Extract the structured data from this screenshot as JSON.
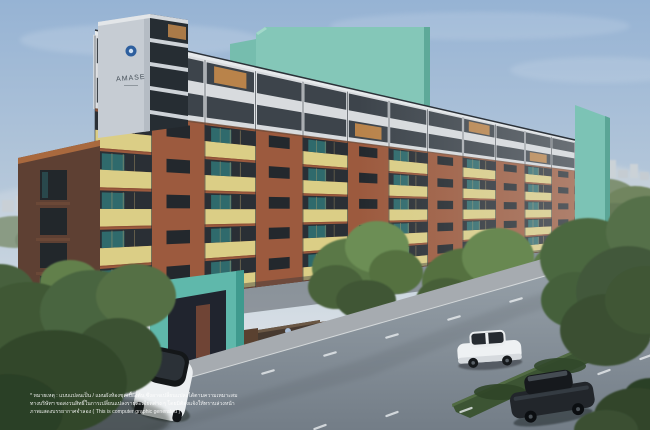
{
  "branding": {
    "tower_sign_label": "AMASE",
    "entrance_sign_label": "AMASE",
    "logo_icon": "amase-logo-icon"
  },
  "disclaimer": {
    "line1": "* หมายเหตุ : แบบแปลนเป็น / แผนผังห้องชุดเบื้องต้น ซึ่งอาจเปลี่ยนแปลงได้ตามความเหมาะสม",
    "line2": "ทางบริษัทฯ ขอสงวนสิทธิ์ในการเปลี่ยนแปลงรายละเอียดต่าง ๆ โดยมิต้องแจ้งให้ทราบล่วงหน้า",
    "line3": "ภาพแสดงบรรยากาศจำลอง ( This is computer graphic generated )"
  },
  "colors": {
    "brand_blue": "#2e5f9e",
    "accent_teal": "#7fc4b6",
    "teal_dark": "#4f9a8c",
    "terracotta": "#9c5a3e",
    "terracotta_dark": "#7e4733",
    "cream_band": "#dbce86",
    "white_panel": "#d8dbde",
    "mullion_dark": "#2f353b",
    "window_dark": "#2a2f35",
    "glass_teal": "#2f6e70",
    "lit_amber": "#b9834a",
    "wood_brown": "#5a4130",
    "sign_wall": "#473a30",
    "fence_corten": "#8a5538",
    "road_grey": "#8d97a0",
    "sidewalk_grey": "#a6abb0",
    "hedge_green": "#3c5433",
    "tree_green": "#4c6741",
    "sky_top": "#96b3d4",
    "sky_bottom": "#dfe3e7",
    "disclaimer_text": "#ffffff"
  }
}
